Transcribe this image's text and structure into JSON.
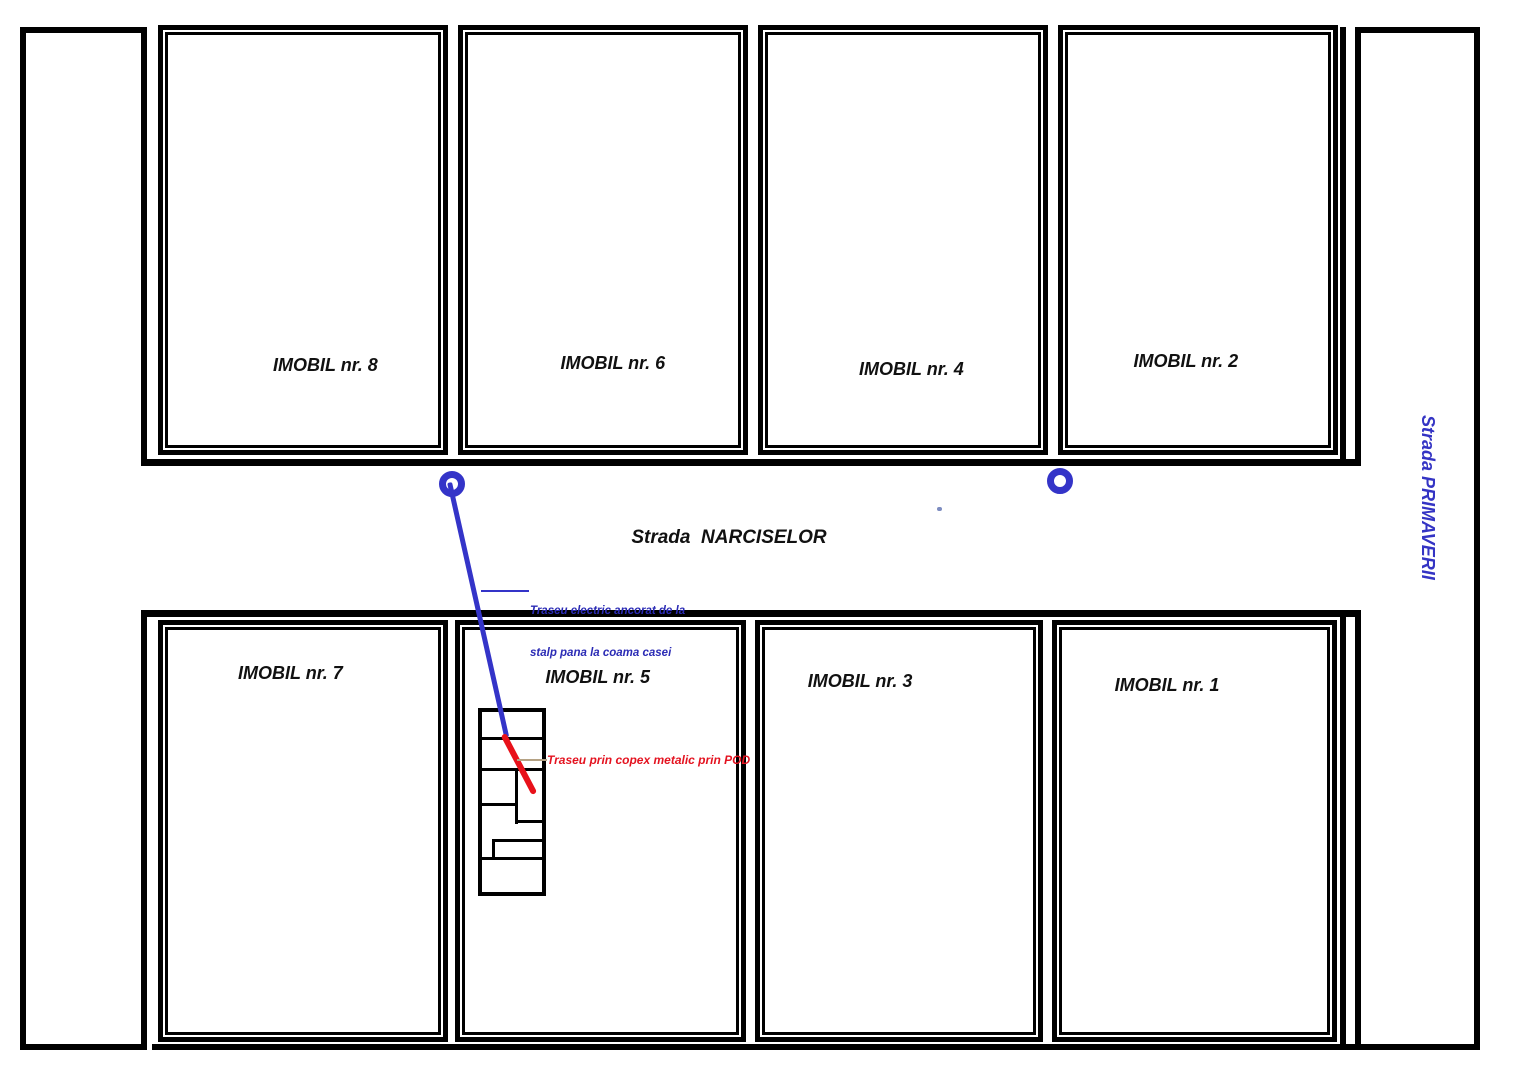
{
  "title": "Plan de situatie - traseu electric",
  "plots": [
    {
      "label": "IMOBIL nr. 8"
    },
    {
      "label": "IMOBIL nr. 6"
    },
    {
      "label": "IMOBIL nr. 4"
    },
    {
      "label": "IMOBIL nr. 2"
    },
    {
      "label": "IMOBIL nr. 7"
    },
    {
      "label": "IMOBIL nr. 5"
    },
    {
      "label": "IMOBIL nr. 3"
    },
    {
      "label": "IMOBIL nr. 1"
    }
  ],
  "streets": {
    "horizontal_label": "Strada  NARCISELOR",
    "vertical_label": "Strada PRIMAVERII"
  },
  "annotations": {
    "aerial_route_line1": "Traseu electric ancorat de la",
    "aerial_route_line2": "stalp pana la coama casei",
    "attic_route": "Traseu prin copex metalic prin POD"
  },
  "icons": {
    "pole_symbol": "utility-pole-ring"
  },
  "colors": {
    "line_black": "#000000",
    "route_blue": "#3434c8",
    "route_red": "#e8111a",
    "text_blue": "#2b2bb5",
    "text_red": "#e41320",
    "connector_tan": "#b5a284"
  }
}
